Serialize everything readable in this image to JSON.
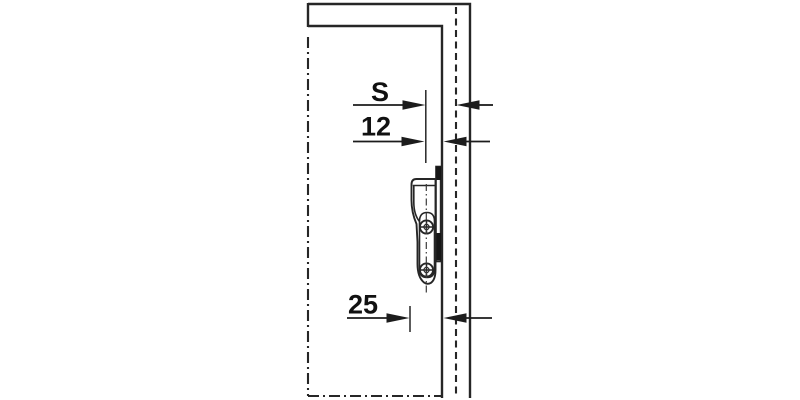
{
  "diagram": {
    "kind": "furniture-fitting-installation-drawing",
    "dimensions": [
      {
        "id": "dim-s",
        "label": "S"
      },
      {
        "id": "dim-12",
        "label": "12"
      },
      {
        "id": "dim-25",
        "label": "25"
      }
    ],
    "icons": {
      "screw_upper": "crosshead-screw-icon",
      "screw_lower": "crosshead-screw-icon"
    },
    "colors": {
      "background": "#ffffff",
      "line": "#262626",
      "text": "#111111",
      "solid_fill": "#161616"
    }
  }
}
